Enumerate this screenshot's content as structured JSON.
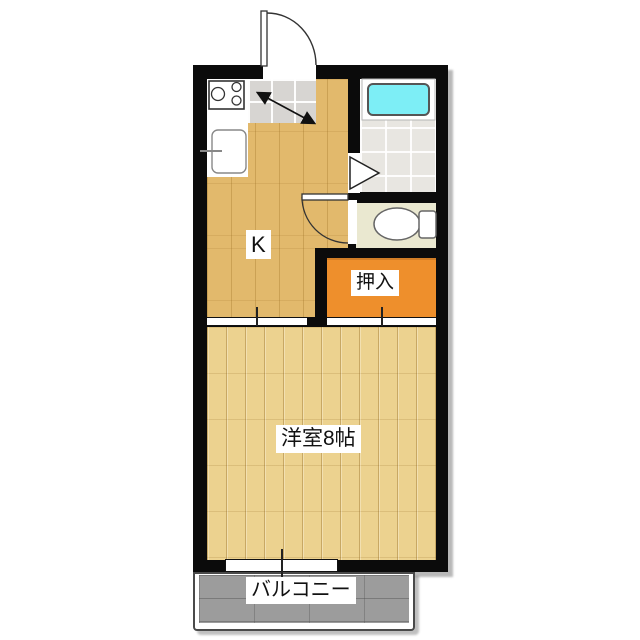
{
  "floorplan": {
    "kind": "apartment-floorplan-1K",
    "rooms": {
      "kitchen": {
        "label": "K"
      },
      "closet": {
        "label": "押入"
      },
      "main_room": {
        "label": "洋室8帖"
      },
      "balcony": {
        "label": "バルコニー"
      }
    },
    "icons": {
      "entrance_door": "entrance-swing-door",
      "genkan_step": "genkan-step-arrow",
      "stove": "stove-2burner",
      "sink": "kitchen-sink",
      "bathtub": "bathtub",
      "bathroom_door": "folding-door-triangle",
      "toilet": "toilet",
      "toilet_door": "swing-door",
      "sliding_doors": "center-tick-marks",
      "window": "sliding-window"
    },
    "colors": {
      "wall": "#0b0b0b",
      "kitchen_floor": "#e2b96c",
      "room_floor": "#ecd28f",
      "closet": "#ee8f2c",
      "bathtub": "#7deef6",
      "bath_tile": "#e8e6e1",
      "toilet_floor": "#eae8d0",
      "genkan_tile": "#d7d5d2",
      "balcony": "#9c9c9c",
      "label_bg": "#ffffff",
      "label_text": "#111111"
    }
  }
}
